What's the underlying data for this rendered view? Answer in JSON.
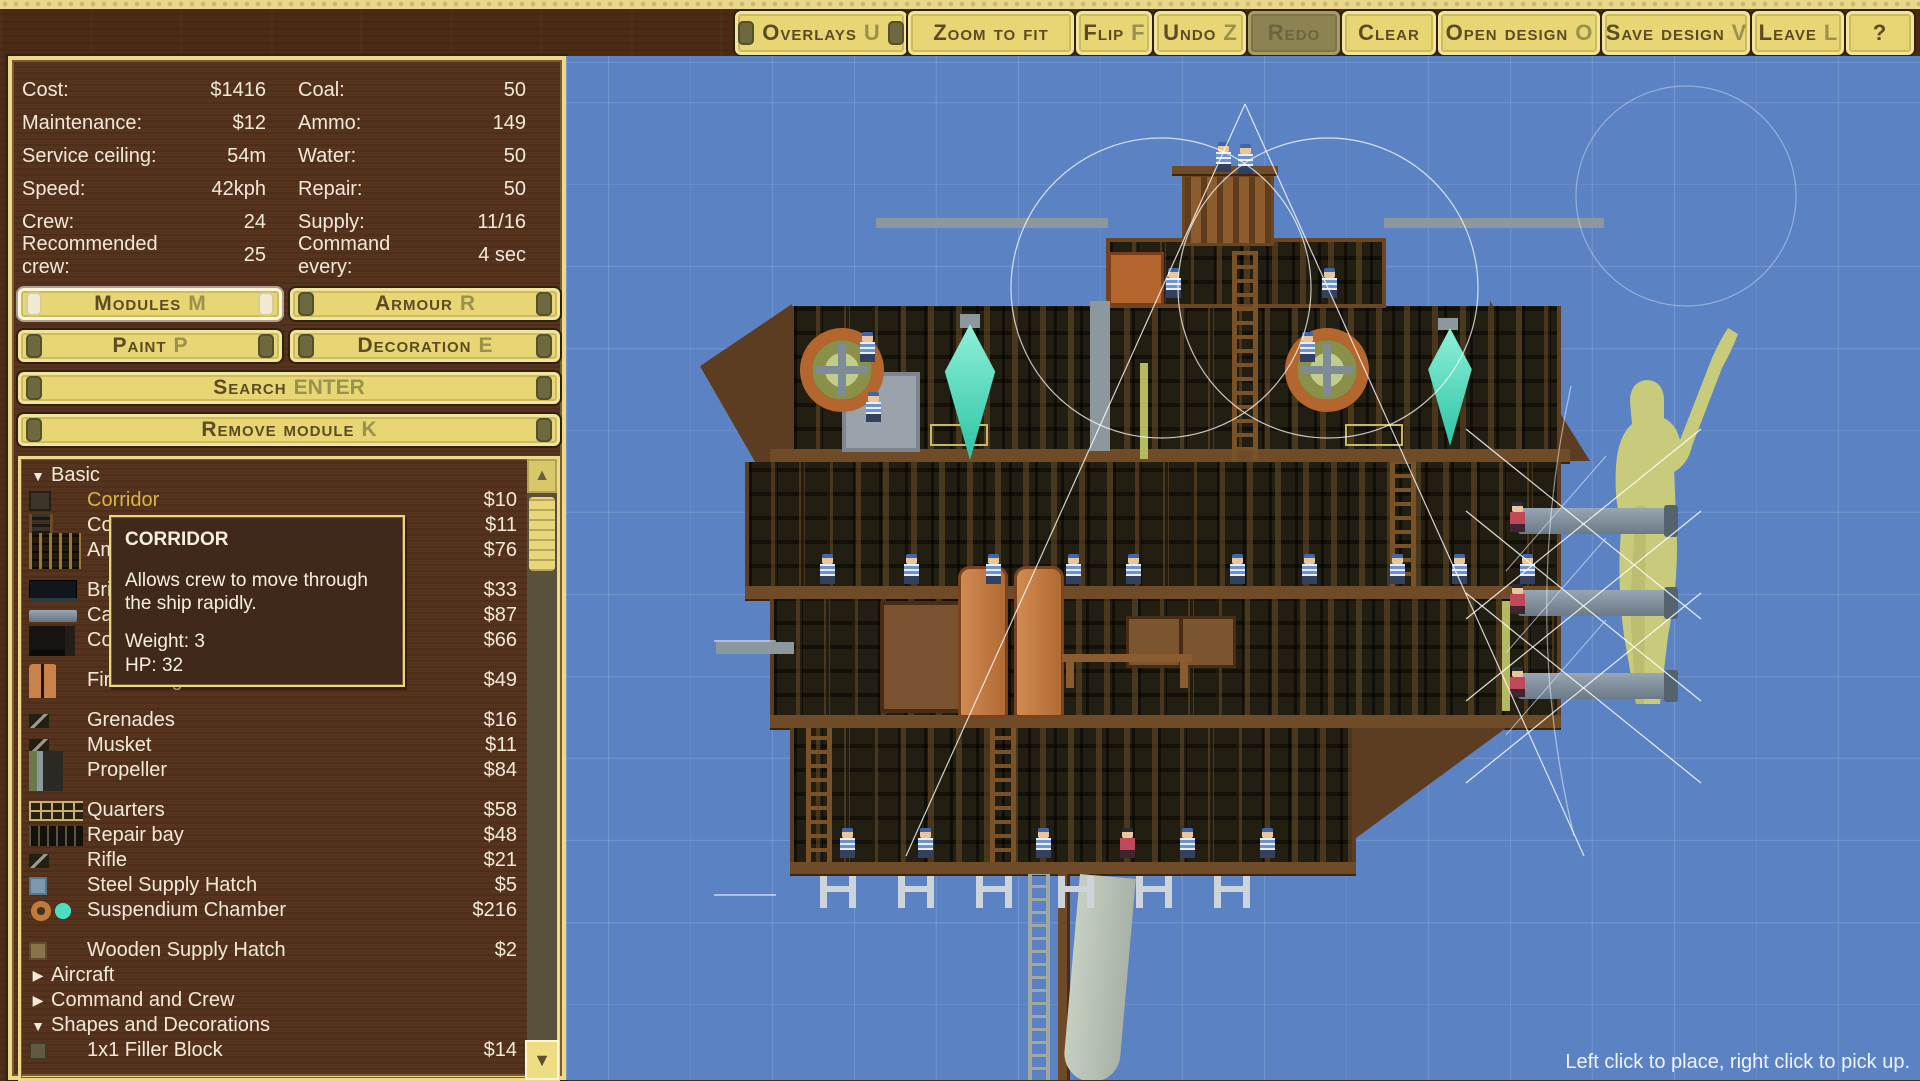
{
  "toolbar": {
    "buttons": [
      {
        "label": "Overlays",
        "key": "U"
      },
      {
        "label": "Zoom to fit",
        "key": ""
      },
      {
        "label": "Flip",
        "key": "F"
      },
      {
        "label": "Undo",
        "key": "Z"
      },
      {
        "label": "Redo",
        "key": "",
        "state": "disabled"
      },
      {
        "label": "Clear",
        "key": ""
      },
      {
        "label": "Open design",
        "key": "O"
      },
      {
        "label": "Save design",
        "key": "V"
      },
      {
        "label": "Leave",
        "key": "L"
      },
      {
        "label": "?",
        "key": ""
      }
    ]
  },
  "stats": {
    "left": [
      {
        "label": "Cost:",
        "value": "$1416"
      },
      {
        "label": "Maintenance:",
        "value": "$12"
      },
      {
        "label": "Service ceiling:",
        "value": "54m"
      },
      {
        "label": "Speed:",
        "value": "42kph"
      },
      {
        "label": "Crew:",
        "value": "24"
      },
      {
        "label": "Recommended crew:",
        "value": "25"
      }
    ],
    "right": [
      {
        "label": "Coal:",
        "value": "50"
      },
      {
        "label": "Ammo:",
        "value": "149"
      },
      {
        "label": "Water:",
        "value": "50"
      },
      {
        "label": "Repair:",
        "value": "50"
      },
      {
        "label": "Supply:",
        "value": "11/16"
      },
      {
        "label": "Command every:",
        "value": "4 sec"
      }
    ]
  },
  "panel_buttons": {
    "modules": {
      "label": "Modules",
      "key": "M",
      "active": true
    },
    "armour": {
      "label": "Armour",
      "key": "R"
    },
    "paint": {
      "label": "Paint",
      "key": "P"
    },
    "decoration": {
      "label": "Decoration",
      "key": "E"
    },
    "search": {
      "label": "Search",
      "key": "ENTER"
    },
    "remove": {
      "label": "Remove module",
      "key": "K"
    }
  },
  "module_list": {
    "scrollbar": {
      "up": "▲",
      "down": "▼"
    },
    "rows": [
      {
        "type": "category",
        "label": "Basic",
        "arrow": "▼",
        "expanded": true
      },
      {
        "type": "item",
        "name": "Corridor",
        "price": "$10",
        "hovered": true
      },
      {
        "type": "item",
        "name": "Corridor with Ladder",
        "price": "$11"
      },
      {
        "type": "item",
        "name": "Ammo Store",
        "price": "$76"
      },
      {
        "type": "item",
        "name": "Bridge",
        "price": "$33"
      },
      {
        "type": "item",
        "name": "Cannon",
        "price": "$87"
      },
      {
        "type": "item",
        "name": "Coal Store",
        "price": "$66"
      },
      {
        "type": "item",
        "name": "Fire Extinguisher",
        "price": "$49"
      },
      {
        "type": "item",
        "name": "Grenades",
        "price": "$16"
      },
      {
        "type": "item",
        "name": "Musket",
        "price": "$11"
      },
      {
        "type": "item",
        "name": "Propeller",
        "price": "$84"
      },
      {
        "type": "item",
        "name": "Quarters",
        "price": "$58"
      },
      {
        "type": "item",
        "name": "Repair bay",
        "price": "$48"
      },
      {
        "type": "item",
        "name": "Rifle",
        "price": "$21"
      },
      {
        "type": "item",
        "name": "Steel Supply Hatch",
        "price": "$5"
      },
      {
        "type": "item",
        "name": "Suspendium Chamber",
        "price": "$216"
      },
      {
        "type": "item",
        "name": "Wooden Supply Hatch",
        "price": "$2"
      },
      {
        "type": "category",
        "label": "Aircraft",
        "arrow": "▶",
        "expanded": false
      },
      {
        "type": "category",
        "label": "Command and Crew",
        "arrow": "▶",
        "expanded": false
      },
      {
        "type": "category",
        "label": "Shapes and Decorations",
        "arrow": "▼",
        "expanded": true
      },
      {
        "type": "item",
        "name": "1x1 Filler Block",
        "price": "$14"
      }
    ]
  },
  "tooltip": {
    "title": "CORRIDOR",
    "body": "Allows crew to move through the ship rapidly.",
    "weight": "Weight: 3",
    "hp": "HP: 32"
  },
  "canvas": {
    "hint": "Left click to place, right click to pick up."
  },
  "colors": {
    "accent_yellow": "#e7d673",
    "panel_wood": "#56331d",
    "canvas_blue": "#5b83c4",
    "hover_gold": "#d9b54a",
    "crystal_teal": "#3fd0b0"
  }
}
